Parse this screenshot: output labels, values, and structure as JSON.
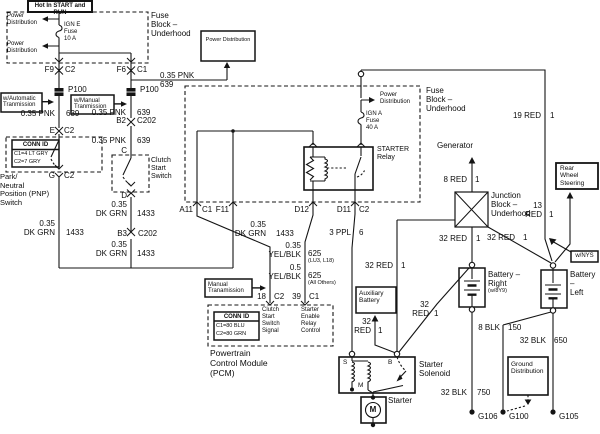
{
  "boxes": {
    "hot": "Hot In START and RUN",
    "fuse_block_1": "Fuse\nBlock –\nUnderhood",
    "power_dist_tl1": "Power\nDistribution",
    "power_dist_tl2": "Power\nDistribution",
    "ign_e": "IGN E\nFuse\n10 A",
    "power_distribution_ref": "Power Distribution",
    "w_automatic": "w/Automatic\nTranmission",
    "w_manual": "w/Manual\nTranmission",
    "conn_id_1": {
      "title": "CONN ID",
      "row1": "C1=4 LT GRY",
      "row2": "C2=7 GRY"
    },
    "pnp": "Park/\nNeutral\nPosition (PNP)\nSwitch",
    "clutch": "Clutch\nStart\nSwitch",
    "fuse_block_2": "Fuse\nBlock –\nUnderhood",
    "power_dist_inner": "Power\nDistribution",
    "ign_a": "IGN A\nFuse\n40 A",
    "starter_relay": "STARTER\nRelay",
    "manual_trans_ref": "Manual\nTranamission",
    "conn_id_2": {
      "title": "CONN ID",
      "row1": "C1=80 BLU",
      "row2": "C2=80 GRN"
    },
    "pcm_sig1": "Clutch\nStart\nSwitch\nSignal",
    "pcm_sig2": "Starter\nEnable\nRelay\nControl",
    "pcm": "Powertrain\nControl Module\n(PCM)",
    "generator_ref": "Generator",
    "junction_block": "Junction\nBlock –\nUnderhood",
    "rws": "Rear\nWheel\nSteering",
    "wnys": "w/NYS",
    "battery_right": "Battery –\nRight",
    "battery_right_note": "(w/8Y9)",
    "battery_left": "Battery –\nLeft",
    "aux_battery": "Auxiliary\nBattery",
    "starter_solenoid": "Starter\nSolenoid",
    "starter": "Starter",
    "motor_m": "M",
    "ground_dist": "Ground\nDistribution"
  },
  "pins": {
    "f9": "F9",
    "f9c": "C2",
    "f6": "F6",
    "f6c": "C1",
    "p100_l": "P100",
    "p100_r": "P100",
    "e": "E",
    "ec": "C2",
    "g": "G",
    "gc": "C2",
    "b2": "B2",
    "b2c": "C202",
    "c": "C",
    "d": "D",
    "b3": "B3",
    "b3c": "C202",
    "a11": "A11",
    "a11c": "C1",
    "f11": "F11",
    "d12": "D12",
    "d11": "D11",
    "d11c": "C2",
    "p18": "18",
    "p18c": "C2",
    "p39": "39",
    "p39c": "C1",
    "s": "S",
    "b": "B",
    "m": "M",
    "g106": "G106",
    "g100": "G100",
    "g105": "G105"
  },
  "wires": {
    "pnk_top": "0.35 PNK\n639",
    "pnk_auto": "0.35 PNK",
    "pnk_auto_n": "639",
    "pnk_man1": "0.35 PNK",
    "pnk_man1_n": "639",
    "pnk_man2": "0.35 PNK",
    "pnk_man2_n": "639",
    "dkgrn_left": "0.35\nDK GRN",
    "dkgrn_left_n": "1433",
    "dkgrn_man1": "0.35\nDK GRN",
    "dkgrn_man1_n": "1433",
    "dkgrn_man2": "0.35\nDK GRN",
    "dkgrn_man2_n": "1433",
    "dkgrn_pcm": "0.35\nDK GRN",
    "dkgrn_pcm_n": "1433",
    "yelblk1": "0.35\nYEL/BLK",
    "yelblk1_n": "625",
    "yelblk1_note": "(LU3, L18)",
    "yelblk2": "0.5\nYEL/BLK",
    "yelblk2_n": "625",
    "yelblk2_note": "(All Others)",
    "ppl": "3 PPL",
    "ppl_n": "6",
    "red19": "19 RED",
    "red19_n": "1",
    "red8": "8 RED",
    "red8_n": "1",
    "red13": "13\nRED",
    "red13_n": "1",
    "red32_jb": "32 RED",
    "red32_jb_n": "1",
    "red32_br": "32 RED",
    "red32_br_n": "1",
    "red32_bl": "32 RED",
    "red32_bl_n": "1",
    "red32_diag": "32\nRED",
    "red32_diag_n": "1",
    "red32_aux": "32\nRED",
    "red32_aux_n": "1",
    "blk32_750": "32 BLK",
    "blk32_750_n": "750",
    "blk8": "8 BLK",
    "blk8_n": "150",
    "blk32_650": "32 BLK",
    "blk32_650_n": "650"
  }
}
